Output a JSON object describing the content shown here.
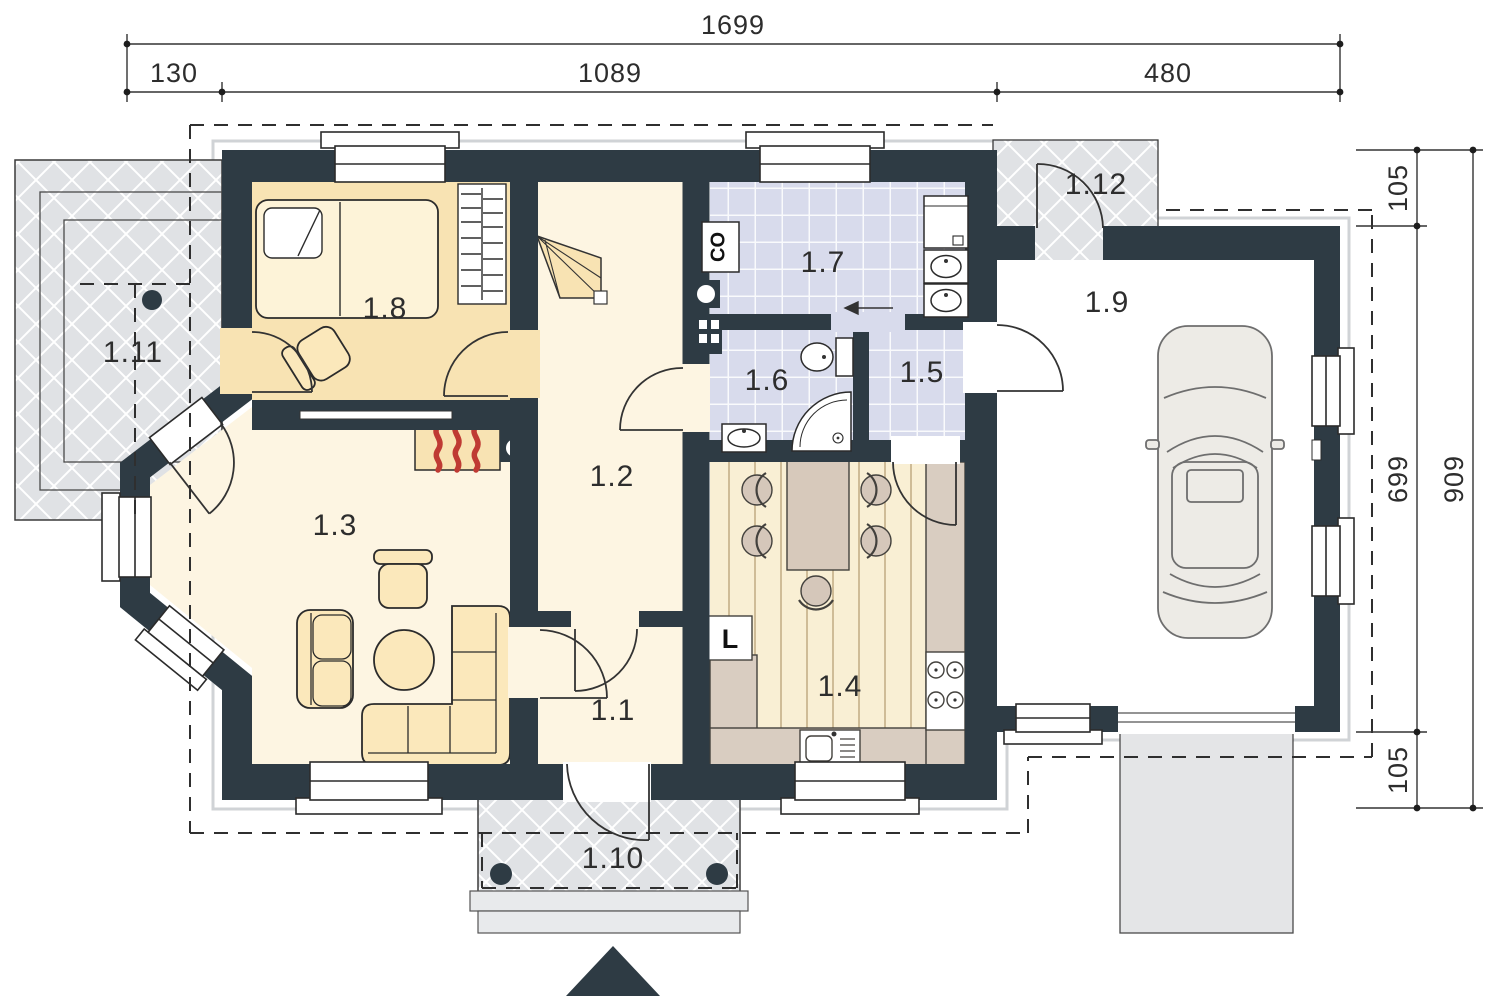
{
  "plan": {
    "dimensions": {
      "top_total": "1699",
      "top_segments": [
        "130",
        "1089",
        "480"
      ],
      "right_total": "909",
      "right_segments": [
        "105",
        "699",
        "105"
      ]
    },
    "rooms": [
      {
        "id": "1.1",
        "label": "1.1"
      },
      {
        "id": "1.2",
        "label": "1.2"
      },
      {
        "id": "1.3",
        "label": "1.3"
      },
      {
        "id": "1.4",
        "label": "1.4"
      },
      {
        "id": "1.5",
        "label": "1.5"
      },
      {
        "id": "1.6",
        "label": "1.6"
      },
      {
        "id": "1.7",
        "label": "1.7"
      },
      {
        "id": "1.8",
        "label": "1.8"
      },
      {
        "id": "1.9",
        "label": "1.9"
      },
      {
        "id": "1.10",
        "label": "1.10"
      },
      {
        "id": "1.11",
        "label": "1.11"
      },
      {
        "id": "1.12",
        "label": "1.12"
      }
    ],
    "markers": {
      "boiler": "CO",
      "fridge": "L"
    },
    "colors": {
      "wall": "#2e3b44",
      "floor_cream": "#fdf5e2",
      "floor_wheat": "#f8e3b3",
      "floor_tile": "#d8dbec",
      "floor_plank": "#f9efd4",
      "counter": "#d9cdc1",
      "paving": "#e0e2e5",
      "flame_red": "#bf3a33"
    }
  }
}
